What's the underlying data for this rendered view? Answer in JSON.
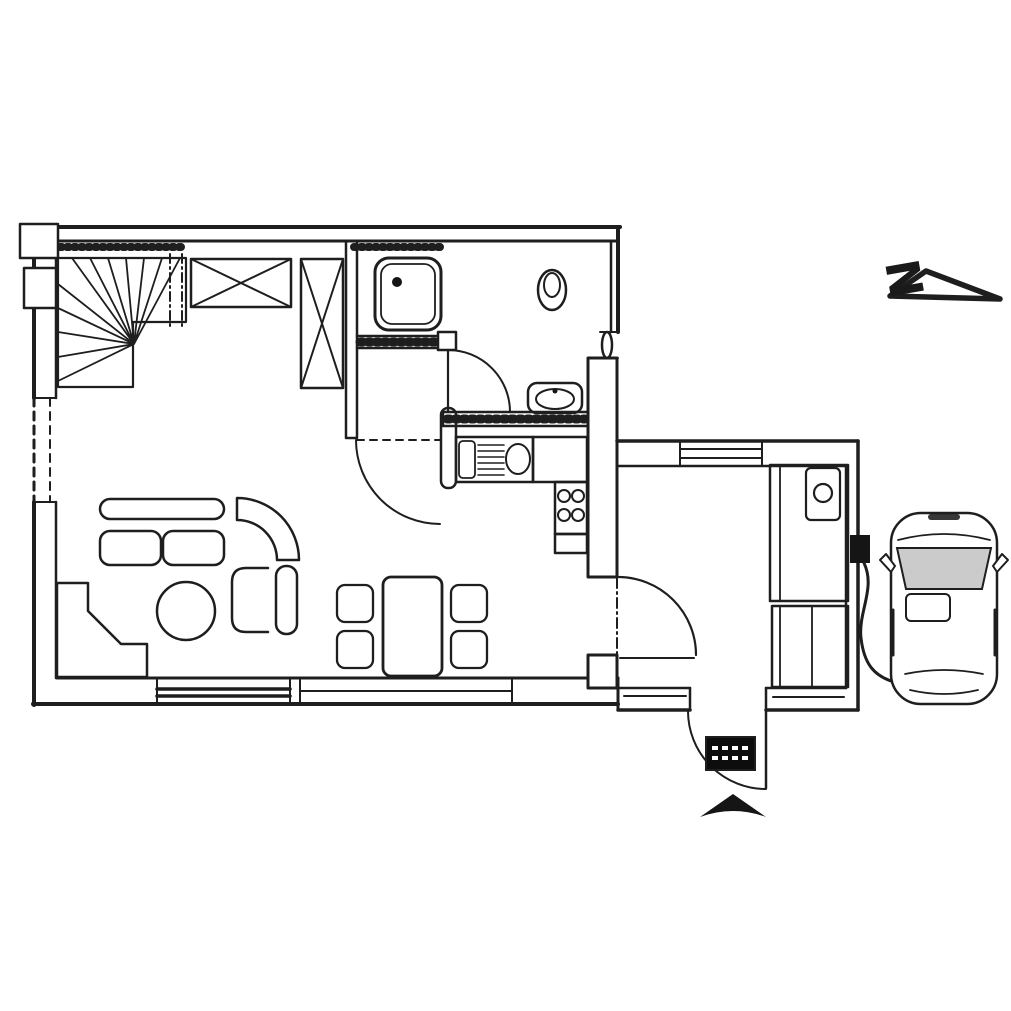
{
  "compass": {
    "letter": "N"
  },
  "palette": {
    "ink": "#1e1e1e",
    "paper": "#ffffff",
    "windshield_glass": "#cbcbcb",
    "doormat": "#0d0d0d"
  },
  "plan": {
    "kind": "scanned ground-floor plan, black ink on white paper",
    "rooms": [
      "stair-hall",
      "bathroom",
      "kitchen",
      "living-dining-room",
      "entry-hall"
    ],
    "fixtures": [
      "winder-staircase",
      "built-in-closet-x",
      "built-in-closet-x-tall",
      "shower",
      "toilet",
      "washbasin",
      "kitchen-sink-with-drainboard",
      "cooktop-4-burners",
      "kitchen-counter",
      "kitchen-peninsula",
      "sofa-two-seat",
      "corner-sofa-element",
      "armchair",
      "round-coffee-table",
      "dining-table",
      "dining-chair",
      "dining-chair",
      "dining-chair",
      "dining-chair",
      "corner-fireplace",
      "tall-cabinet-with-appliance",
      "two-door-cupboard",
      "entrance-door",
      "doormat",
      "entrance-arrow",
      "wallbox-with-charging-cable",
      "car-top-view",
      "north-arrow"
    ]
  }
}
